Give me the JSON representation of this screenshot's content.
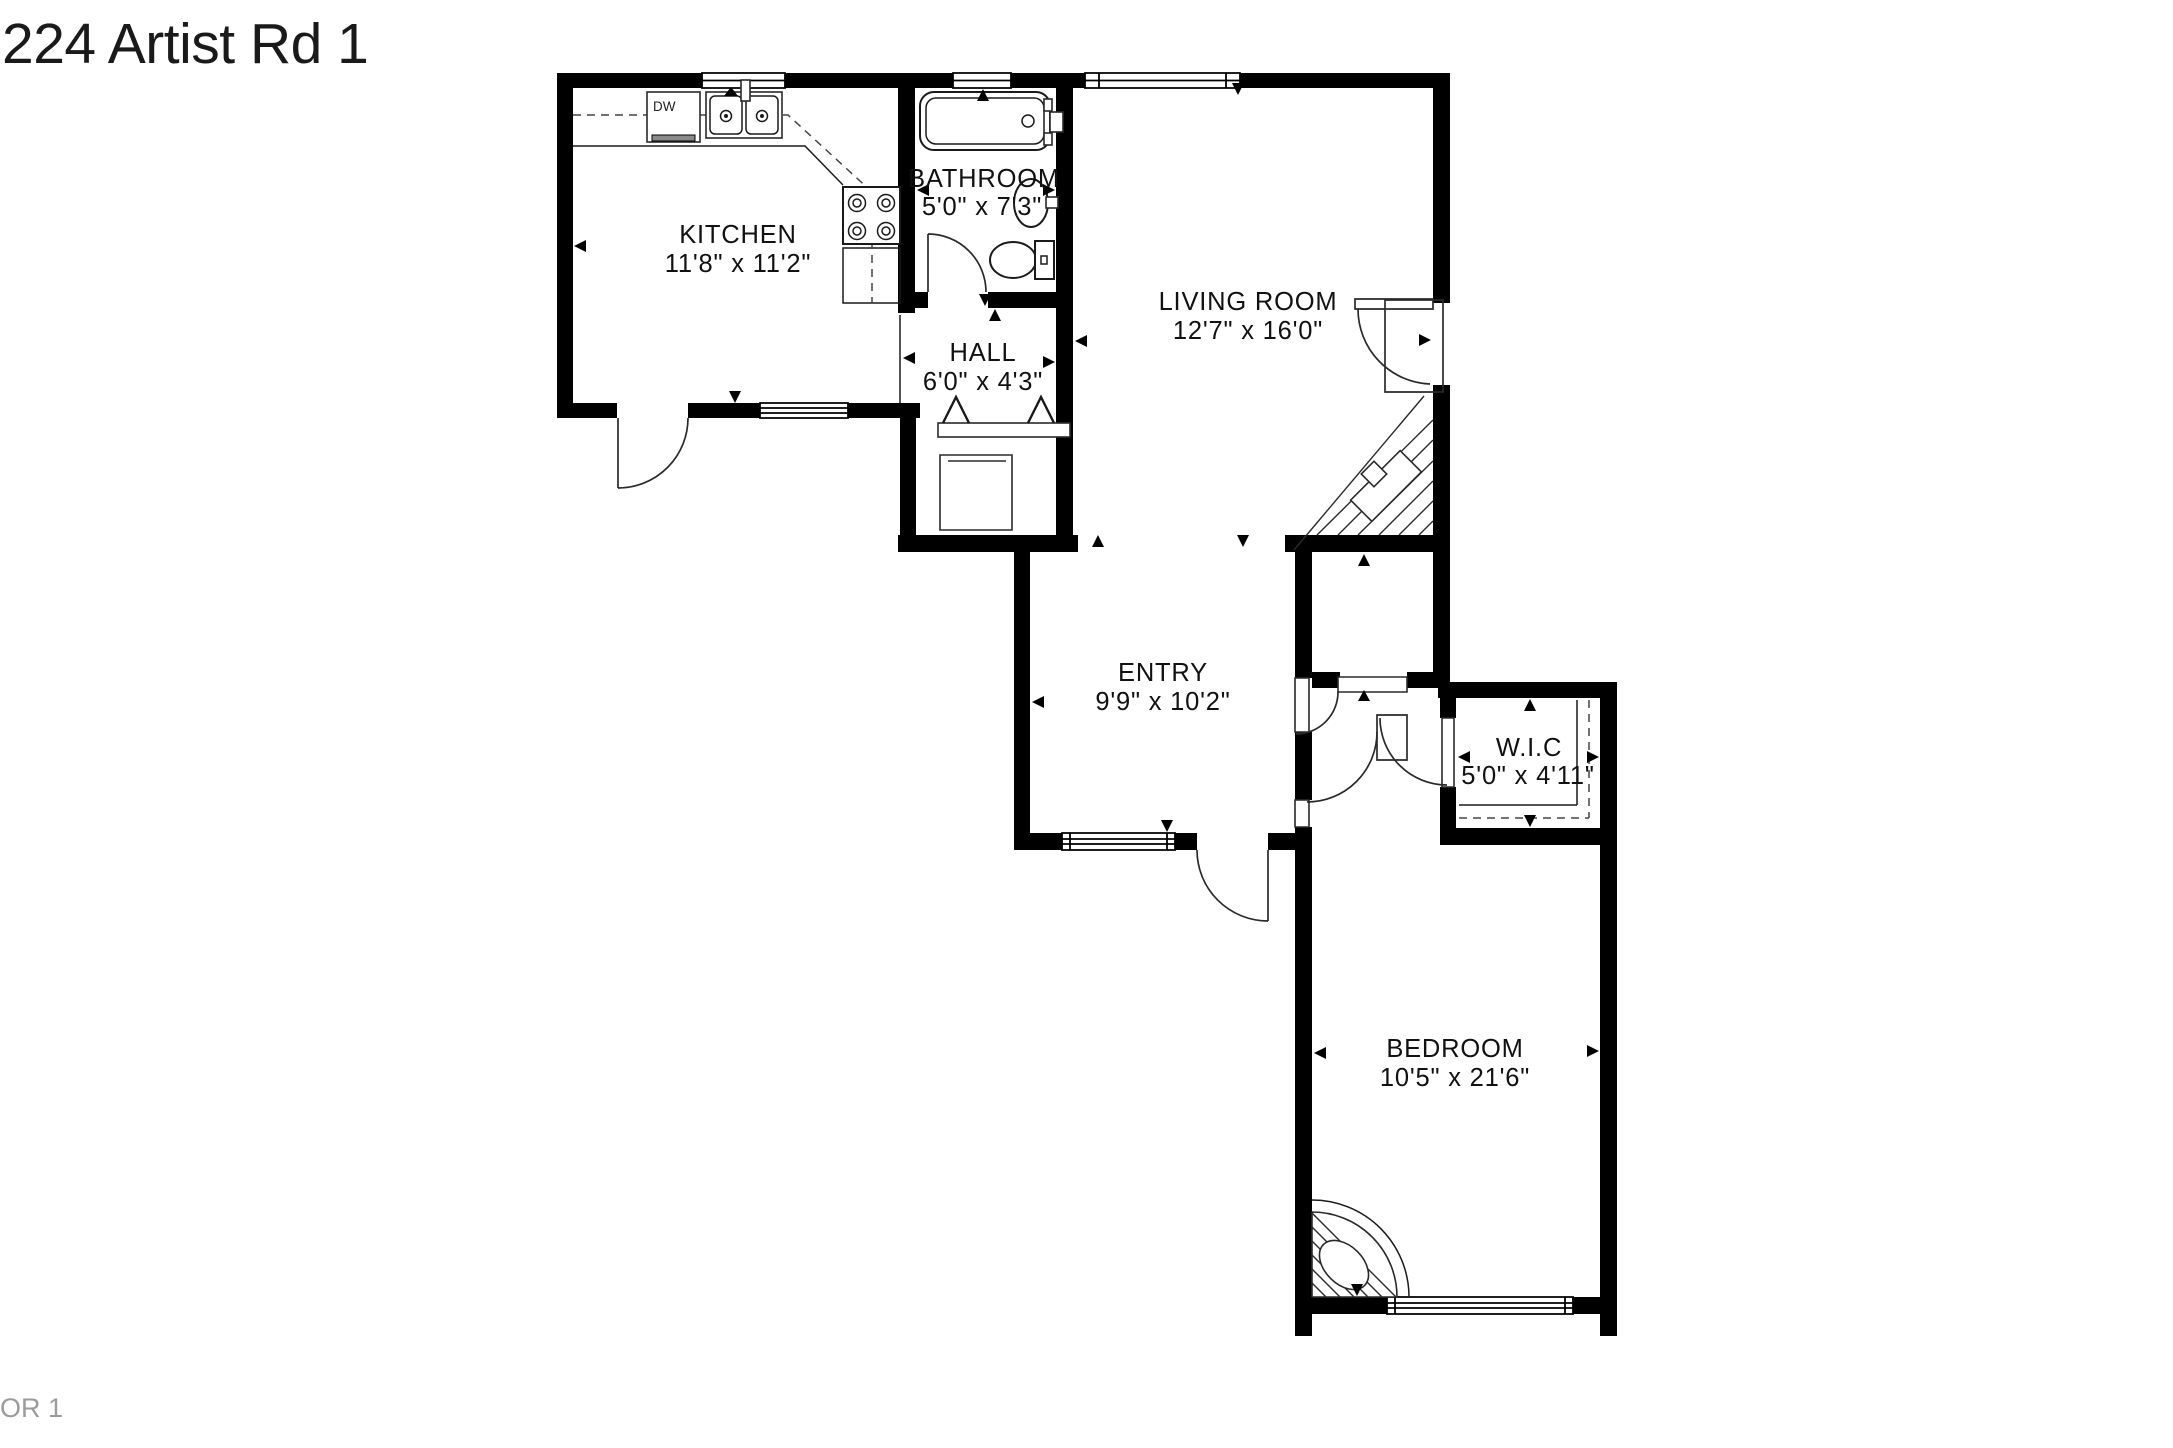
{
  "title": "224 Artist Rd 1",
  "floor_label": "OR 1",
  "rooms": [
    {
      "name": "KITCHEN",
      "dims": "11'8\" x 11'2\""
    },
    {
      "name": "BATHROOM",
      "dims": "5'0\" x 7'3\""
    },
    {
      "name": "HALL",
      "dims": "6'0\" x 4'3\""
    },
    {
      "name": "LIVING ROOM",
      "dims": "12'7\" x 16'0\""
    },
    {
      "name": "ENTRY",
      "dims": "9'9\" x 10'2\""
    },
    {
      "name": "W.I.C",
      "dims": "5'0\" x 4'11\""
    },
    {
      "name": "BEDROOM",
      "dims": "10'5\" x 21'6\""
    }
  ],
  "fixtures": {
    "dishwasher_label": "DW"
  },
  "colors": {
    "wall": "#000000",
    "line": "#2a2a2a",
    "text": "#111111",
    "muted_text": "#9b9b9b",
    "background": "#ffffff"
  }
}
